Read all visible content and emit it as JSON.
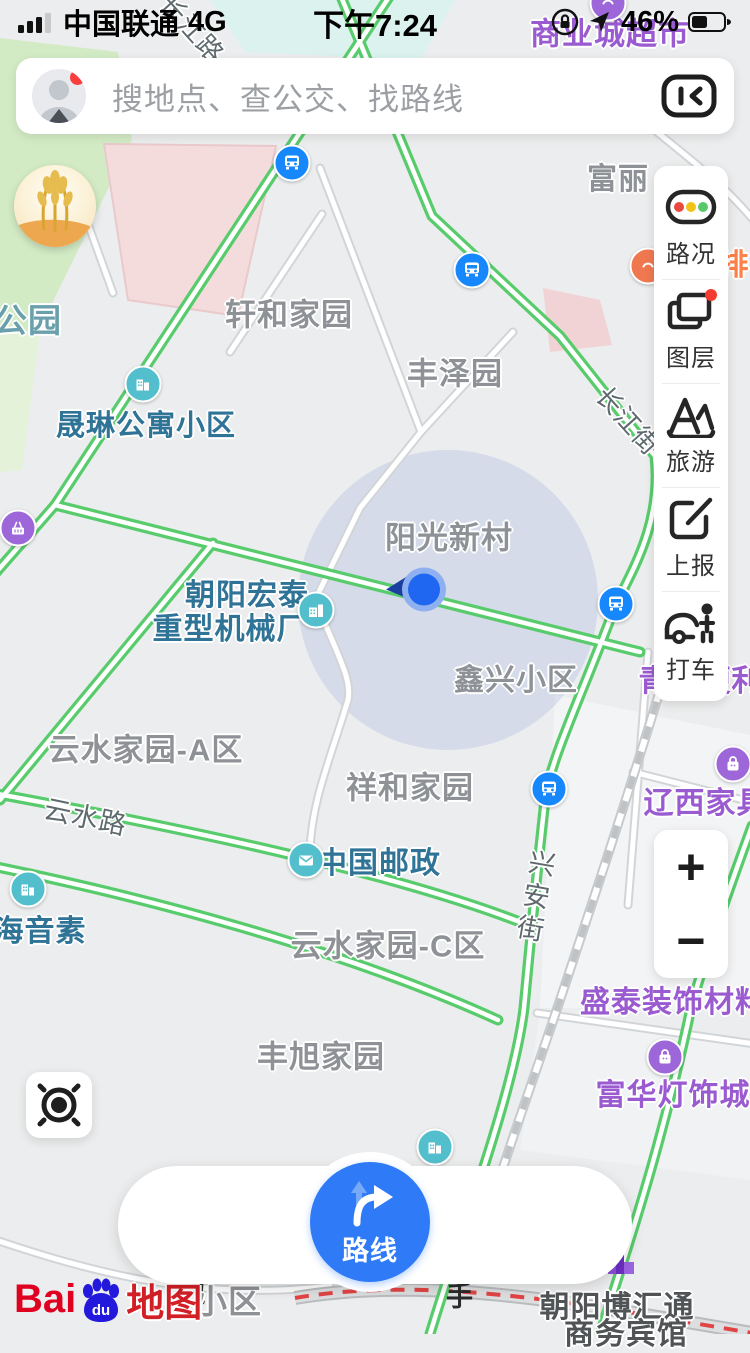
{
  "status_bar": {
    "carrier": "中国联通",
    "network": "4G",
    "time": "下午7:24",
    "battery_percent": "46%"
  },
  "search": {
    "placeholder": "搜地点、查公交、找路线"
  },
  "tools": {
    "items": [
      {
        "label": "路况",
        "icon": "traffic-light-icon"
      },
      {
        "label": "图层",
        "icon": "layers-icon",
        "badge": true
      },
      {
        "label": "旅游",
        "icon": "travel-icon"
      },
      {
        "label": "上报",
        "icon": "report-icon"
      },
      {
        "label": "打车",
        "icon": "taxi-icon"
      }
    ]
  },
  "zoom_controls": {
    "zoom_in": "+",
    "zoom_out": "−"
  },
  "bottom_bar": {
    "discover": "发现周边",
    "route": "路线",
    "assistant": "出行助手"
  },
  "logo": {
    "bai": "Bai",
    "du": "du",
    "map_word": "地图"
  },
  "colors": {
    "accent_blue": "#2f7af7",
    "road_green": "#58cc6c",
    "poi_teal": "#53bfcd",
    "poi_purple": "#9d67d9",
    "bus_blue": "#1788fb",
    "label_gray": "#8e9296",
    "label_blue": "#2f7397",
    "label_purple": "#9a5ad0"
  },
  "map": {
    "labels": [
      {
        "text": "商业城超市",
        "x": 610,
        "y": 31,
        "type": "poi-purple",
        "size": 31
      },
      {
        "text": "富丽",
        "x": 618,
        "y": 176,
        "type": "district",
        "size": 30
      },
      {
        "text": "排",
        "x": 734,
        "y": 262,
        "type": "poi-orange",
        "size": 30
      },
      {
        "text": "轩和家园",
        "x": 289,
        "y": 312,
        "type": "district",
        "size": 31
      },
      {
        "text": "公园",
        "x": 28,
        "y": 318,
        "type": "park",
        "size": 33
      },
      {
        "text": "丰泽园",
        "x": 455,
        "y": 371,
        "type": "district",
        "size": 31
      },
      {
        "text": "晟琳公寓小区",
        "x": 146,
        "y": 423,
        "type": "poi-blue",
        "size": 29
      },
      {
        "text": "长江街",
        "x": 629,
        "y": 420,
        "type": "road",
        "size": 26,
        "rot": 48
      },
      {
        "text": "长江路",
        "x": 193,
        "y": 28,
        "type": "road",
        "size": 26,
        "rot": 48
      },
      {
        "text": "阳光新村",
        "x": 449,
        "y": 535,
        "type": "district",
        "size": 31
      },
      {
        "text": "朝阳宏泰",
        "x": 247,
        "y": 592,
        "type": "poi-blue",
        "size": 30
      },
      {
        "text": "重型机械厂",
        "x": 230,
        "y": 626,
        "type": "poi-blue",
        "size": 30
      },
      {
        "text": "鑫兴小区",
        "x": 516,
        "y": 677,
        "type": "district",
        "size": 30
      },
      {
        "text": "青清便利店",
        "x": 716,
        "y": 678,
        "type": "poi-purple",
        "size": 30
      },
      {
        "text": "云水家园-A区",
        "x": 146,
        "y": 747,
        "type": "district",
        "size": 31
      },
      {
        "text": "祥和家园",
        "x": 410,
        "y": 785,
        "type": "district",
        "size": 31
      },
      {
        "text": "辽西家具城",
        "x": 721,
        "y": 800,
        "type": "poi-purple",
        "size": 30
      },
      {
        "text": "云水路",
        "x": 86,
        "y": 815,
        "type": "road",
        "size": 27,
        "rot": 12
      },
      {
        "text": "中国邮政",
        "x": 379,
        "y": 860,
        "type": "poi-blue",
        "size": 30
      },
      {
        "text": "兴安街",
        "x": 534,
        "y": 898,
        "type": "road",
        "size": 27,
        "vertical": true,
        "rot": 10
      },
      {
        "text": "海音素",
        "x": 40,
        "y": 928,
        "type": "poi-blue",
        "size": 30
      },
      {
        "text": "云水家园-C区",
        "x": 388,
        "y": 943,
        "type": "district",
        "size": 31
      },
      {
        "text": "盛泰装饰材料",
        "x": 673,
        "y": 999,
        "type": "poi-purple",
        "size": 30
      },
      {
        "text": "丰旭家园",
        "x": 321,
        "y": 1054,
        "type": "district",
        "size": 31
      },
      {
        "text": "富华灯饰城",
        "x": 673,
        "y": 1092,
        "type": "poi-purple",
        "size": 30
      },
      {
        "text": "小区",
        "x": 228,
        "y": 1299,
        "type": "district",
        "size": 33
      },
      {
        "text": "朝阳博汇通",
        "x": 617,
        "y": 1304,
        "type": "poi-dark",
        "size": 30
      },
      {
        "text": "商务宾馆",
        "x": 626,
        "y": 1331,
        "type": "poi-dark",
        "size": 30
      }
    ],
    "icons": [
      {
        "glyph": "bus-icon",
        "x": 292,
        "y": 163,
        "bg": "#1788fb"
      },
      {
        "glyph": "bus-icon",
        "x": 472,
        "y": 270,
        "bg": "#1788fb"
      },
      {
        "glyph": "bus-icon",
        "x": 616,
        "y": 604,
        "bg": "#1788fb"
      },
      {
        "glyph": "bus-icon",
        "x": 549,
        "y": 789,
        "bg": "#1788fb"
      },
      {
        "glyph": "building-icon",
        "x": 143,
        "y": 384,
        "bg": "#53bfcd"
      },
      {
        "glyph": "factory-icon",
        "x": 316,
        "y": 610,
        "bg": "#53bfcd"
      },
      {
        "glyph": "envelope-icon",
        "x": 306,
        "y": 860,
        "bg": "#53bfcd"
      },
      {
        "glyph": "building-icon",
        "x": 28,
        "y": 889,
        "bg": "#53bfcd"
      },
      {
        "glyph": "building-icon",
        "x": 435,
        "y": 1147,
        "bg": "#53bfcd"
      },
      {
        "glyph": "bag-icon",
        "x": 733,
        "y": 764,
        "bg": "#9d67d9"
      },
      {
        "glyph": "bag-icon",
        "x": 665,
        "y": 1057,
        "bg": "#9d67d9"
      },
      {
        "glyph": "basket-icon",
        "x": 18,
        "y": 528,
        "bg": "#9d67d9"
      },
      {
        "glyph": "shop-building-icon",
        "x": 621,
        "y": 1261,
        "bg": "flat"
      },
      {
        "glyph": "dot-icon",
        "x": 648,
        "y": 266,
        "bg": "#f07850"
      },
      {
        "glyph": "dot-icon",
        "x": 608,
        "y": 3,
        "bg": "#9d67d9"
      }
    ]
  }
}
